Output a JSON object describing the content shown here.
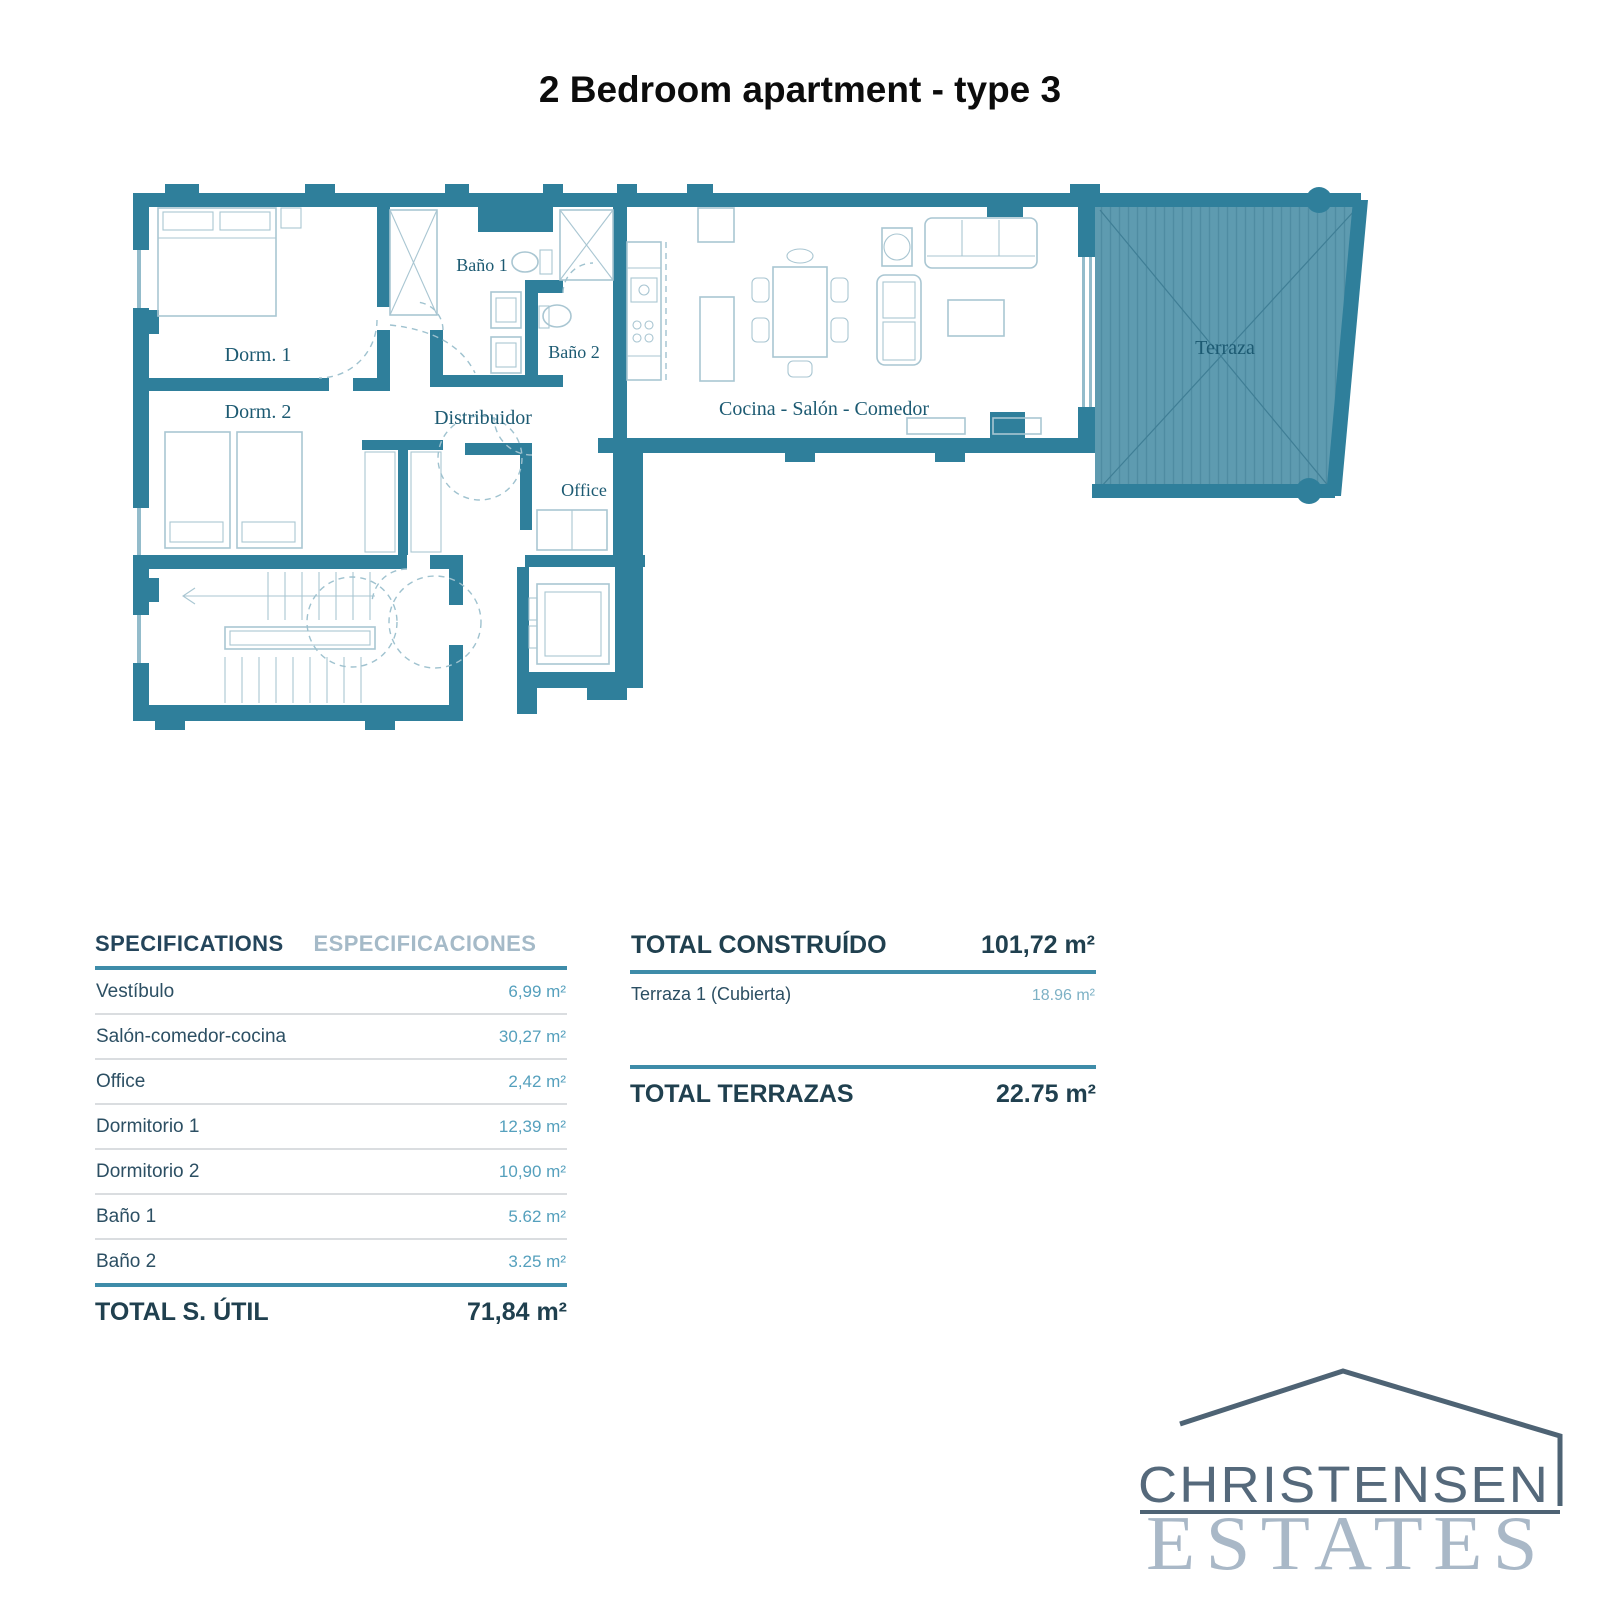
{
  "title": "2 Bedroom apartment - type 3",
  "floor_plan": {
    "labels": {
      "dorm1": "Dorm. 1",
      "dorm2": "Dorm. 2",
      "bano1": "Baño 1",
      "bano2": "Baño 2",
      "distribuidor": "Distribuidor",
      "office": "Office",
      "living": "Cocina - Salón - Comedor",
      "terraza": "Terraza"
    },
    "colors": {
      "wall_teal": "#2f7f9b",
      "terrace_fill": "#5e9bb0",
      "furniture_line": "#a9c6d2",
      "room_label": "#1c5a72"
    }
  },
  "spec_table": {
    "header_en": "SPECIFICATIONS",
    "header_es": "ESPECIFICACIONES",
    "rows": [
      {
        "label": "Vestíbulo",
        "value": "6,99 m²"
      },
      {
        "label": "Salón-comedor-cocina",
        "value": "30,27 m²"
      },
      {
        "label": "Office",
        "value": "2,42 m²"
      },
      {
        "label": "Dormitorio 1",
        "value": "12,39 m²"
      },
      {
        "label": "Dormitorio 2",
        "value": "10,90 m²"
      },
      {
        "label": "Baño 1",
        "value": "5.62 m²"
      },
      {
        "label": "Baño 2",
        "value": "3.25 m²"
      }
    ],
    "total_label": "TOTAL S. ÚTIL",
    "total_value": "71,84 m²"
  },
  "totals_table": {
    "construido_label": "TOTAL CONSTRUÍDO",
    "construido_value": "101,72 m²",
    "rows": [
      {
        "label": "Terraza 1 (Cubierta)",
        "value": "18.96 m²"
      }
    ],
    "terrazas_label": "TOTAL TERRAZAS",
    "terrazas_value": "22.75 m²"
  },
  "logo": {
    "name_top": "CHRISTENSEN",
    "name_bottom": "ESTATES"
  },
  "accent_colors": {
    "table_rule": "#3e8ca9",
    "value_teal": "#55a0bd",
    "navy": "#20404f",
    "logo_slate": "#55697b",
    "logo_light_serif": "#a9b8c7"
  }
}
